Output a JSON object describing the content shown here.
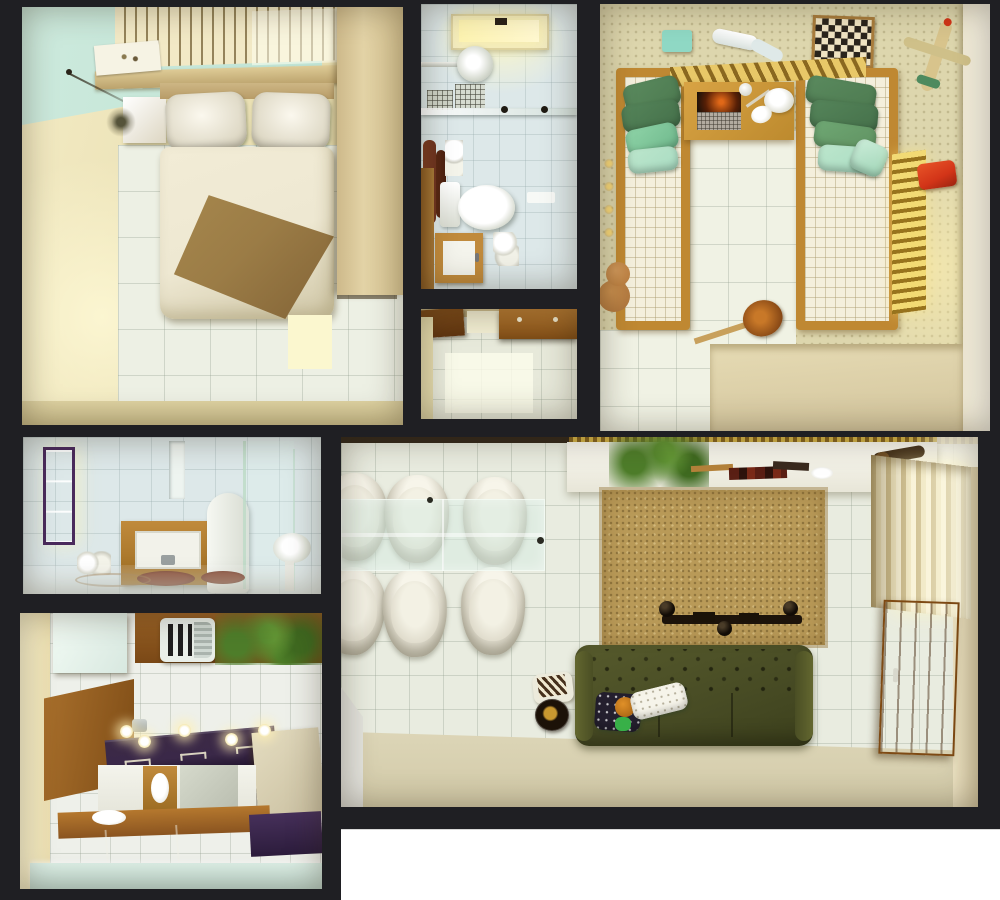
{
  "image_type": "3D rendered top-down dollhouse floor plan of a small apartment, seven room panels separated by dark frame walls",
  "palette": {
    "frame": "#1f1f23",
    "paper_white": "#ffffff",
    "bedroom_wall": "#e9dfb2",
    "teal_ceiling": "#bfe3d4",
    "wood": "#c08a3c",
    "wood_dark": "#8a5a22",
    "tile_floor": "#edf0e4",
    "marble": "#dde8e9",
    "wallpaper": "#ddd6ad",
    "quilt": "#f4efdc",
    "pillow_green": "#4d7a50",
    "pillow_mint": "#a9dcc2",
    "duvet": "#eee8d2",
    "blanket_brown": "#9b7c46",
    "olive_sofa": "#474b24",
    "rug": "#b99a58",
    "purple_counter": "#3a2848",
    "mint_cabinet": "#dcefe6",
    "curtain": "#efe6c2",
    "skylight": "#fdf3b0",
    "red_toy": "#d23418",
    "plant_green": "#4e7d2a",
    "towel_brown": "#6e3420",
    "gold_trim": "#d9b84a",
    "glass": "#cfe4da"
  },
  "rooms": [
    {
      "id": "bedroom",
      "label": "Master bedroom: double bed with two pillows, cream duvet, brown throw, teal ceiling band, slatted blinds, shelf with art print, nightstand, wardrobe"
    },
    {
      "id": "bathroom-top",
      "label": "Bathroom: skylight, shower head, glass screen, toilet, vanity door, brown towels"
    },
    {
      "id": "entry",
      "label": "Entry hall: wooden doors, cabinet, bright tile floor"
    },
    {
      "id": "kids-room",
      "label": "Kids bedroom: two beds with green pillows, desk with laptop and lamp, chessboard, toy plane, teddy bear, guitar, toy car, gold radiator"
    },
    {
      "id": "bathroom-2",
      "label": "Second bathroom: purple-framed window, wood vanity, toilet, glass shower, bath mats"
    },
    {
      "id": "kitchen",
      "label": "Kitchen: fridge, wall shelf with vent and fern, wood panel, dark counter with sinks, stove, pendant bulbs, purple worktops, mint cabinets"
    },
    {
      "id": "living-room",
      "label": "Living and dining room: glass table with six white chairs, wall console with plant and books, tan rug with TV and speakers, olive tufted sofa with cushions, banjo, curtains, wooden door"
    }
  ]
}
